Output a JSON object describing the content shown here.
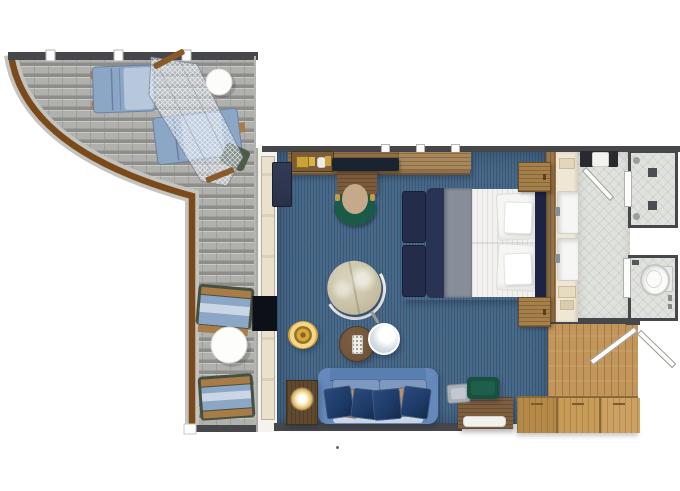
{
  "floorplan": {
    "rooms": [
      {
        "name": "balcony",
        "floor": "teak-deck",
        "furniture": [
          "sun-lounger",
          "sun-lounger",
          "hammock-net-canopy",
          "round-deck-table",
          "deck-armchair",
          "round-deck-table",
          "deck-armchair"
        ]
      },
      {
        "name": "living-sleeping-room",
        "floor": "blue-carpet",
        "furniture": [
          "minibar-counter",
          "console-slab",
          "writing-desk",
          "desk-chair",
          "tall-cabinet",
          "wall-tv",
          "swivel-armchair",
          "gold-ottoman",
          "round-coffee-table",
          "round-side-table",
          "sofa",
          "lamp-side-table",
          "table-lamp",
          "double-bed",
          "bench-ottoman",
          "bench-ottoman",
          "nightstand",
          "nightstand",
          "dresser",
          "green-chair",
          "stool"
        ]
      },
      {
        "name": "dressing-corridor",
        "floor": "tile",
        "furniture": [
          "double-sink-vanity",
          "dark-cabinet"
        ]
      },
      {
        "name": "shower-room",
        "floor": "tile",
        "furniture": [
          "shower-fixtures"
        ]
      },
      {
        "name": "water-closet",
        "floor": "tile",
        "furniture": [
          "toilet"
        ]
      },
      {
        "name": "entry-hall",
        "floor": "oak-parquet",
        "furniture": [
          "wardrobe-closets",
          "entry-door",
          "corridor-door"
        ]
      }
    ],
    "colors": {
      "wall": "#46474b",
      "carpet": "#47698a",
      "tile": "#e0e2de",
      "rail": "#7b4a1a",
      "deck": "#b0b0ad",
      "deck_stripe": "#8d8d8a",
      "counter_wood": "#8f6d46",
      "desk_wood": "#7c5b3b",
      "shelf_wood": "#a8875a",
      "oak": "#c79b58",
      "entry_wood": "#c2955a",
      "cream": "#efe7d4",
      "door_cream": "#e9e1cc",
      "sofa": "#6589bb",
      "sofa_cushion": "#7e99c0",
      "pillow_navy": "#1d3a66",
      "pillow_brown": "#a87f5e",
      "bed_white": "#f2f1ef",
      "bed_gray": "#878e9a",
      "bed_navy": "#2b3355",
      "headboard": "#1d2442",
      "gold": "#d9a032",
      "green_chair": "#175240",
      "desk_chair_green": "#1b5a48",
      "seat_tan": "#c4a98a",
      "armchair": "#c9c2a6",
      "coffee_table": "#6e5339",
      "tv": "#1b2230",
      "navy_cabinet": "#2a3147",
      "lounger_blue": "#8ca6c6"
    }
  }
}
